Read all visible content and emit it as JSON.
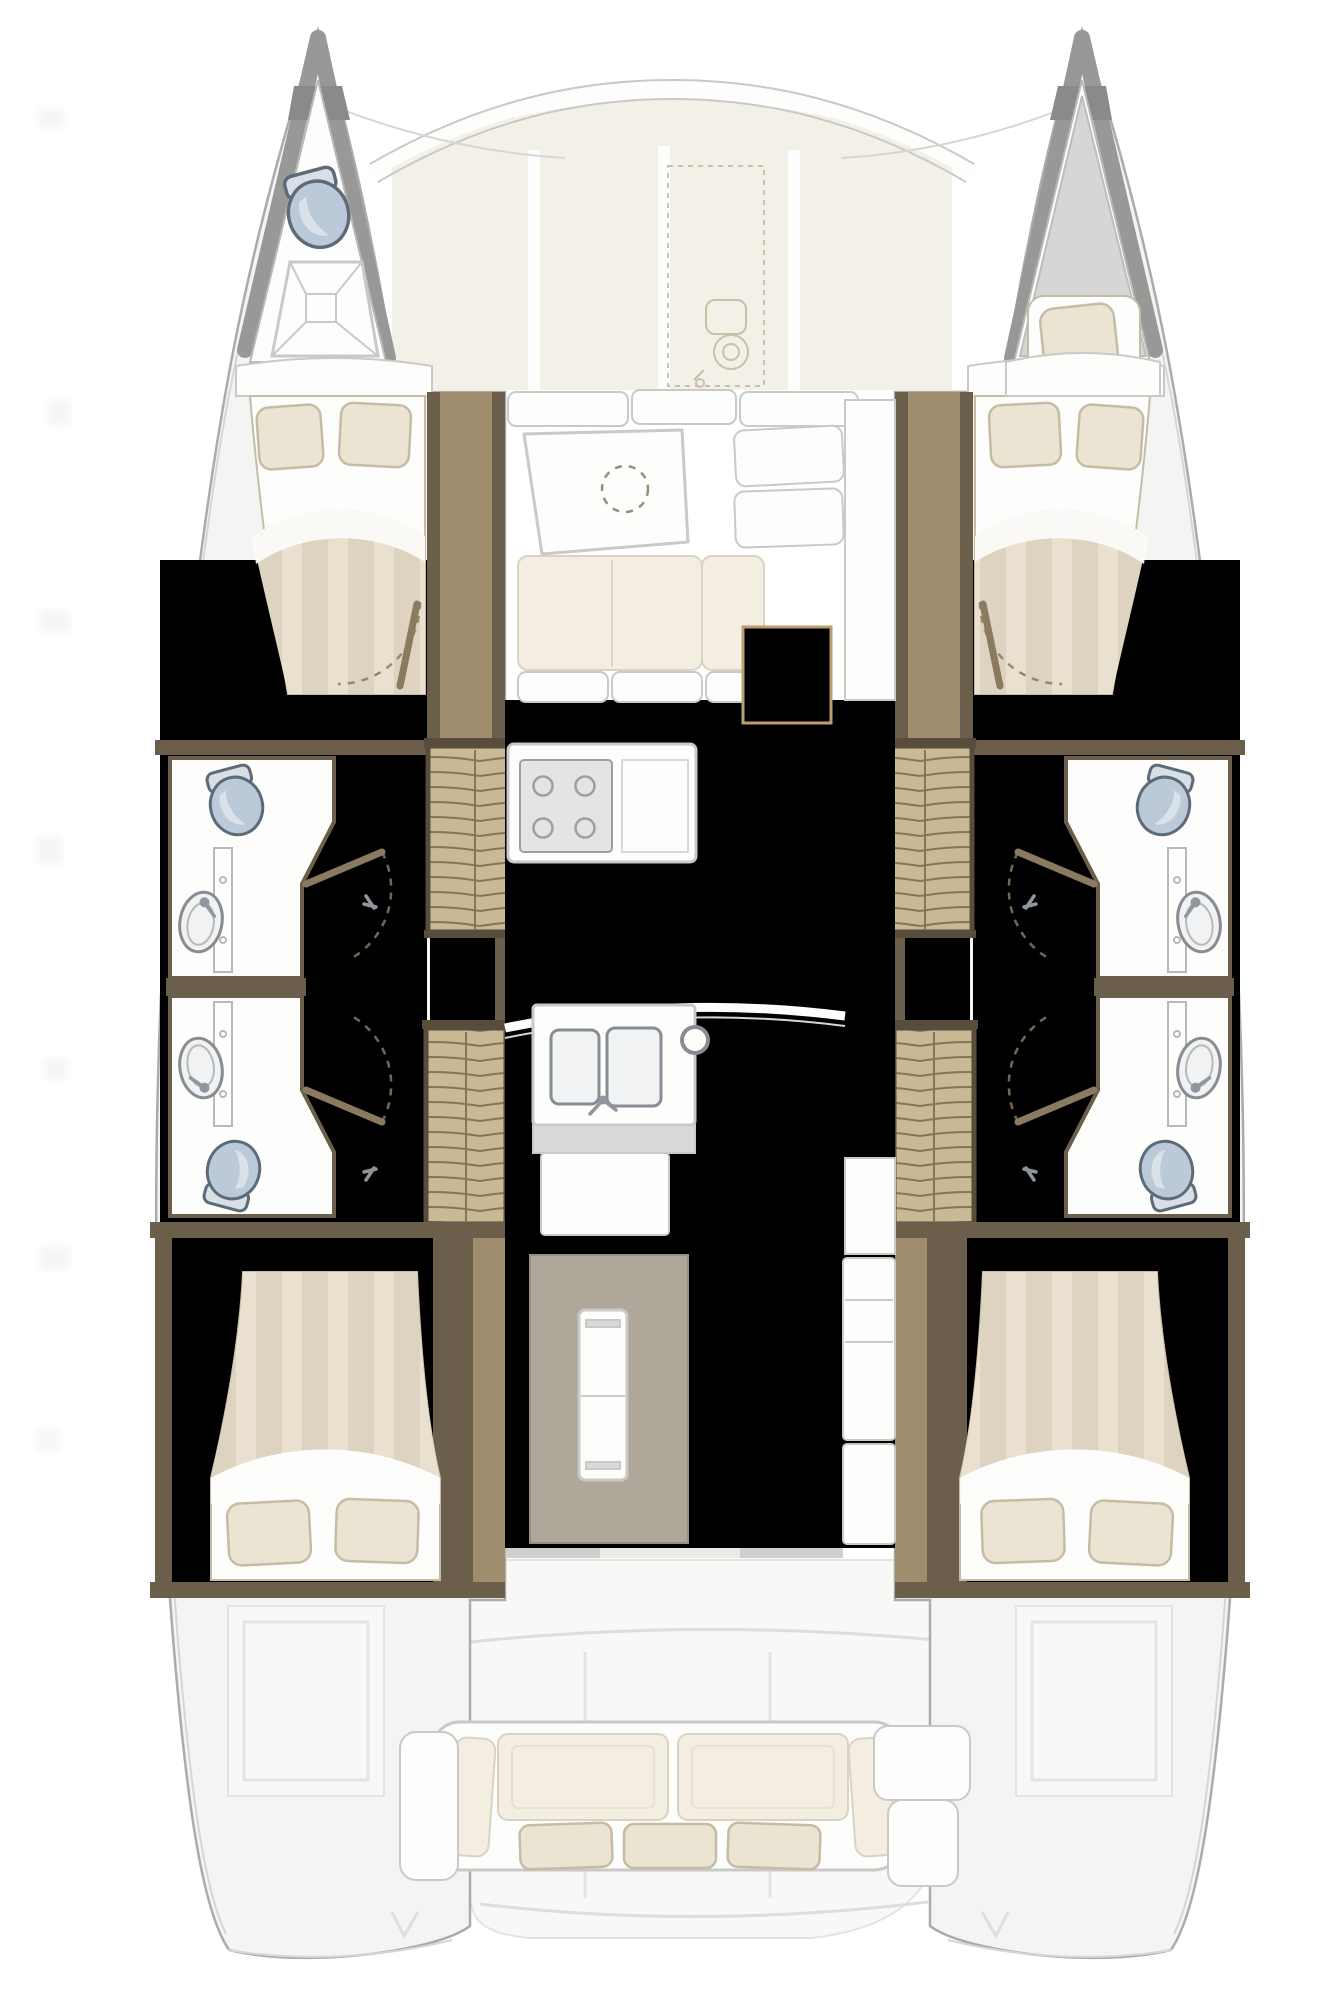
{
  "diagram": {
    "kind": "catamaran-interior-floor-plan",
    "orientation": "bow-up"
  },
  "colors": {
    "paper": "#ffffff",
    "hull_deck": "#f4f4f3",
    "hull_outline": "#ababa9",
    "deck_line": "#d6d6d4",
    "bow_wall": "#989896",
    "bow_wall_dark": "#8a8a88",
    "white_surface": "#fdfdfc",
    "surface_line": "#c9c9c7",
    "bulkhead_line": "#b8b8b6",
    "wall_wood": "#6b5e4a",
    "wall_wood_mid": "#a08d6e",
    "wall_wood_cap": "#584c3b",
    "door_wood": "#8a7a60",
    "floor_wood": "#cfc3ab",
    "floor_wood_line": "#c2b398",
    "floor_wood_hi": "#d8cdb6",
    "saloon_floor": "#d9cfbc",
    "saloon_floor_line": "#cdc2ac",
    "saloon_floor_hi": "#e2d9c8",
    "stairs_wood": "#c9b995",
    "stairs_line": "#85755a",
    "duvet": "#ddd3c0",
    "duvet_stripe": "#e9e0cf",
    "pillow": "#ece4d2",
    "pillow_edge": "#c6bca6",
    "cushion": "#f3eee1",
    "cushion_edge": "#d9d3c2",
    "cream_panel": "#f3f0e8",
    "sketch_line": "#c6bba4",
    "toilet_fill": "#bcc9d8",
    "toilet_edge": "#5d6b79",
    "toilet_tank": "#d9dfe7",
    "sink_fill": "#f0f2f3",
    "sink_edge": "#878d93",
    "metal": "#8f969e",
    "stove_fill": "#e4e4e2",
    "stove_edge": "#9e9e9c",
    "counter_gray": "#d9d9d7",
    "fridge_panel": "#b0a79b",
    "fridge_edge": "#978e82",
    "wicker_fill": "#ead7b4",
    "wicker_line": "#cfae7f",
    "wicker_edge": "#bb9e72",
    "exterior_soft": "#f8f8f7",
    "exterior_line": "#e3e3e1",
    "cockpit_line": "#dedddb",
    "watermark": "#555555"
  },
  "areas": {
    "bow_port_fixtures": [
      "toilet",
      "shower-tray"
    ],
    "bow_starboard_fixtures": [
      "forepeak-berth",
      "pillow"
    ],
    "port_hull": [
      "fore-double-bed",
      "bathroom-fore",
      "bathroom-aft",
      "companionway-steps",
      "locker-steps",
      "aft-double-bed"
    ],
    "starboard_hull": [
      "fore-double-bed",
      "bathroom-fore",
      "bathroom-aft",
      "companionway-steps",
      "locker-steps",
      "aft-double-bed"
    ],
    "saloon": [
      "front-settee",
      "dining-table",
      "l-settee",
      "side-seats",
      "wicker-hatch",
      "stove",
      "galley-counter",
      "double-sink",
      "compression-post",
      "fridge",
      "cabinets"
    ],
    "foredeck": [
      "cream-panels",
      "anchor-windlass-sketch"
    ],
    "cockpit": [
      "aft-sofa",
      "helm-seat-port",
      "helm-seat-starboard",
      "engine-hatch-port",
      "engine-hatch-starboard"
    ]
  }
}
